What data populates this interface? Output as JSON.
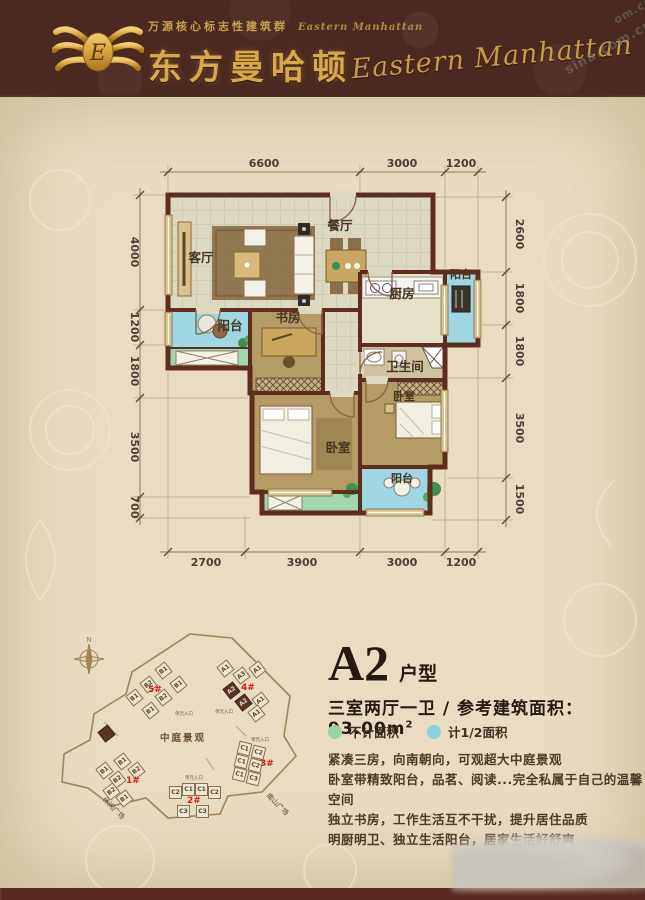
{
  "header": {
    "tagline": "万源核心标志性建筑群",
    "tagline_script": "Eastern Manhattan",
    "title_cn": "东方曼哈顿",
    "title_script_right": "Eastern Manhattan",
    "logo_letter": "E"
  },
  "watermark": {
    "text1": "sina.com.cn",
    "text2": "om.cn"
  },
  "plan": {
    "rooms": {
      "living": "客厅",
      "dining": "餐厅",
      "kitchen": "厨房",
      "balcony": "阳台",
      "study": "书房",
      "bath": "卫生间",
      "bedroom": "卧室"
    },
    "dims": {
      "top": [
        "6600",
        "3000",
        "1200"
      ],
      "bottom": [
        "2700",
        "3900",
        "3000",
        "1200"
      ],
      "left": [
        "4000",
        "1200",
        "1800",
        "3500",
        "700"
      ],
      "right": [
        "2600",
        "1800",
        "1800",
        "3500",
        "1500"
      ]
    }
  },
  "site": {
    "center_label": "中庭景观",
    "street_left": "休闲广场",
    "street_right": "南山广场",
    "entrance_label": "单元入口",
    "compass_n": "N",
    "buildings": [
      {
        "id": "5#",
        "x": 148,
        "y": 685,
        "rot": -38,
        "units": [
          {
            "label": "B1",
            "x": 157,
            "y": 664
          },
          {
            "label": "B1",
            "x": 172,
            "y": 678
          },
          {
            "label": "B2",
            "x": 142,
            "y": 678
          },
          {
            "label": "B1",
            "x": 128,
            "y": 691
          },
          {
            "label": "B2",
            "x": 157,
            "y": 691
          },
          {
            "label": "B1",
            "x": 144,
            "y": 704
          }
        ]
      },
      {
        "id": "4#",
        "x": 241,
        "y": 683,
        "rot": -38,
        "units": [
          {
            "label": "A1",
            "x": 219,
            "y": 662
          },
          {
            "label": "A3",
            "x": 235,
            "y": 669
          },
          {
            "label": "A1",
            "x": 251,
            "y": 663
          },
          {
            "label": "A2",
            "x": 225,
            "y": 684,
            "dark": true
          },
          {
            "label": "A2",
            "x": 237,
            "y": 696,
            "dark": true
          },
          {
            "label": "A1",
            "x": 254,
            "y": 694
          },
          {
            "label": "A1",
            "x": 250,
            "y": 707
          }
        ]
      },
      {
        "id": "3#",
        "x": 260,
        "y": 759,
        "rot": 14,
        "units": [
          {
            "label": "C1",
            "x": 238,
            "y": 742
          },
          {
            "label": "C2",
            "x": 252,
            "y": 746
          },
          {
            "label": "C1",
            "x": 235,
            "y": 755
          },
          {
            "label": "C2",
            "x": 249,
            "y": 759
          },
          {
            "label": "C1",
            "x": 233,
            "y": 768
          },
          {
            "label": "C3",
            "x": 247,
            "y": 772
          }
        ]
      },
      {
        "id": "2#",
        "x": 187,
        "y": 796,
        "rot": 0,
        "units": [
          {
            "label": "C2",
            "x": 169,
            "y": 786
          },
          {
            "label": "C1",
            "x": 182,
            "y": 783
          },
          {
            "label": "C1",
            "x": 195,
            "y": 783
          },
          {
            "label": "C2",
            "x": 208,
            "y": 786
          },
          {
            "label": "C3",
            "x": 177,
            "y": 805
          },
          {
            "label": "C3",
            "x": 196,
            "y": 805
          }
        ]
      },
      {
        "id": "1#",
        "x": 126,
        "y": 776,
        "rot": -38,
        "units": [
          {
            "label": "B1",
            "x": 116,
            "y": 755
          },
          {
            "label": "B2",
            "x": 130,
            "y": 764
          },
          {
            "label": "B1",
            "x": 98,
            "y": 764
          },
          {
            "label": "B2",
            "x": 111,
            "y": 773
          },
          {
            "label": "B2",
            "x": 105,
            "y": 785
          },
          {
            "label": "B1",
            "x": 118,
            "y": 792
          },
          {
            "label": "",
            "x": 100,
            "y": 727,
            "dark": true
          }
        ]
      }
    ],
    "entrances": [
      {
        "x": 174,
        "y": 710
      },
      {
        "x": 214,
        "y": 708
      },
      {
        "x": 184,
        "y": 774
      },
      {
        "x": 250,
        "y": 736
      }
    ]
  },
  "info": {
    "type_code": "A2",
    "type_suffix": "户型",
    "spec_rooms": "三室两厅一卫",
    "spec_sep": " / ",
    "spec_area_label": "参考建筑面积：",
    "spec_area_value": "93.00m",
    "spec_area_sup": "2",
    "legend": [
      {
        "label": "不计面积",
        "color": "#9bd3a4"
      },
      {
        "label": "计1/2面积",
        "color": "#8ccfdf"
      }
    ],
    "desc_lines": [
      "紧凑三房，向南朝向，可观超大中庭景观",
      "卧室带精致阳台，品茗、阅读...完全私属于自己的温馨空间",
      "独立书房，工作生活互不干扰，提升居住品质",
      "明厨明卫、独立生活阳台，居家生活好舒爽"
    ]
  },
  "colors": {
    "accent_red": "#c0241c",
    "gold": "#d8a847",
    "wall": "#5e2d1e",
    "balcony_blue": "#9ed6e2",
    "planter_green": "#a2d6ab",
    "wood": "#b59c66"
  }
}
